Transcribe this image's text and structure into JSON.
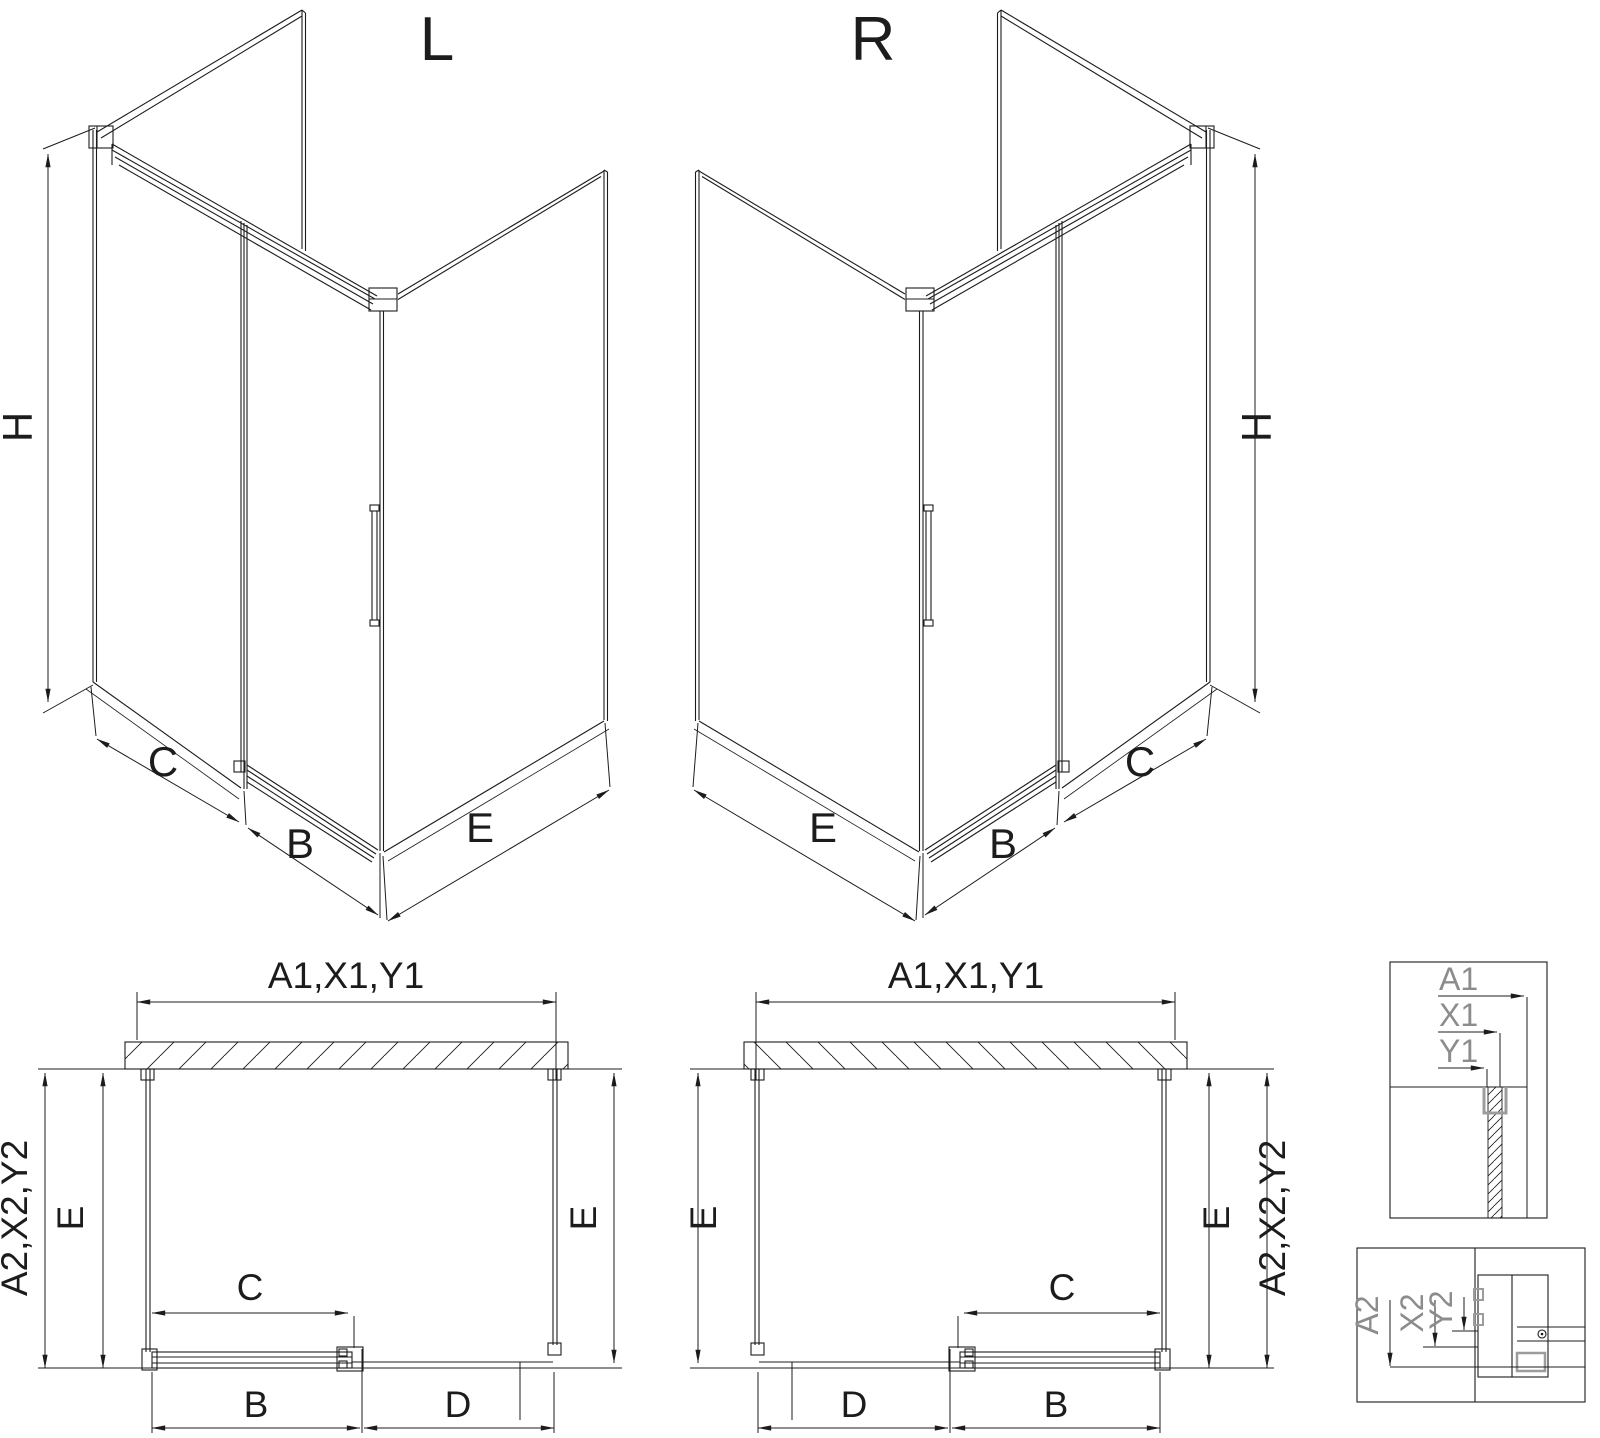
{
  "iso_left": {
    "label": "L",
    "dim_h": "H",
    "dim_c": "C",
    "dim_b": "B",
    "dim_e": "E"
  },
  "iso_right": {
    "label": "R",
    "dim_h": "H",
    "dim_c": "C",
    "dim_b": "B",
    "dim_e": "E"
  },
  "plan_left": {
    "dim_top": "A1,X1,Y1",
    "dim_side": "A2,X2,Y2",
    "dim_e_left": "E",
    "dim_e_right": "E",
    "dim_c": "C",
    "dim_b": "B",
    "dim_d": "D"
  },
  "plan_right": {
    "dim_top": "A1,X1,Y1",
    "dim_side": "A2,X2,Y2",
    "dim_e_left": "E",
    "dim_e_right": "E",
    "dim_c": "C",
    "dim_b": "B",
    "dim_d": "D"
  },
  "detail_wall": {
    "dim_a1": "A1",
    "dim_x1": "X1",
    "dim_y1": "Y1"
  },
  "detail_door": {
    "dim_a2": "A2",
    "dim_x2": "X2",
    "dim_y2": "Y2"
  },
  "colors": {
    "line": "#1c1c1c",
    "detail_label": "#8c8c8c",
    "background": "#ffffff"
  }
}
